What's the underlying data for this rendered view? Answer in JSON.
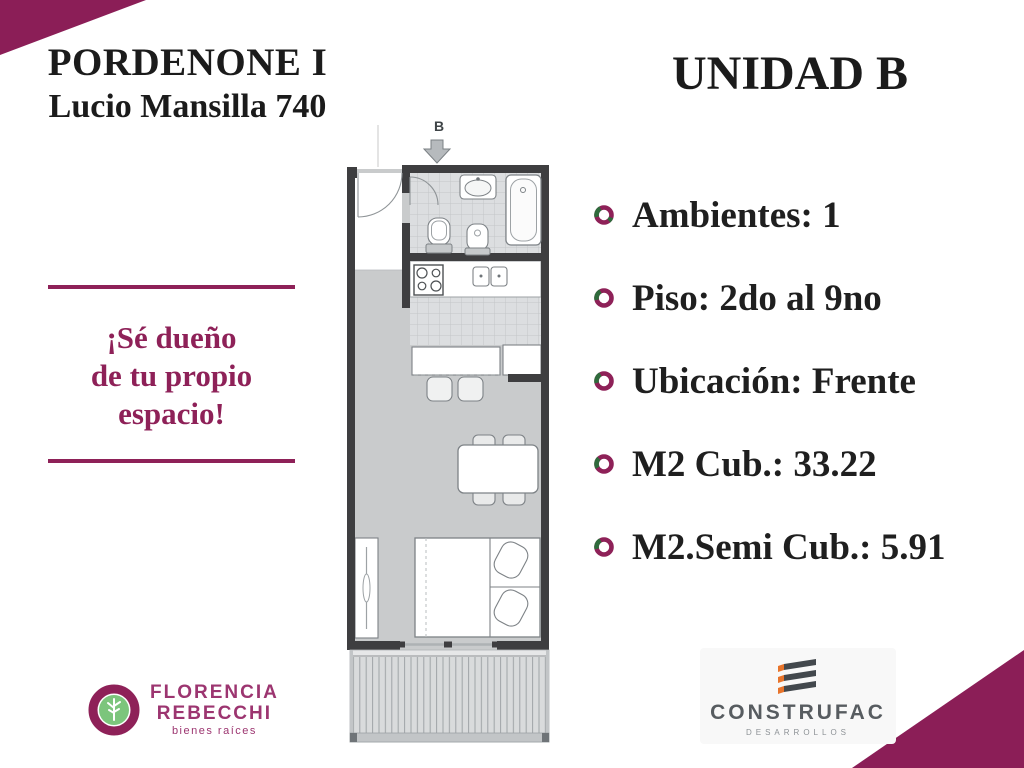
{
  "header": {
    "project_title": "PORDENONE I",
    "address": "Lucio Mansilla 740",
    "unit_title": "UNIDAD B"
  },
  "features": {
    "items": [
      "Ambientes: 1",
      "Piso: 2do al 9no",
      "Ubicación: Frente",
      "M2 Cub.: 33.22",
      "M2.Semi Cub.: 5.91"
    ]
  },
  "slogan": {
    "line1": "¡Sé dueño",
    "line2": "de tu propio",
    "line3": "espacio!"
  },
  "floorplan": {
    "entrance_label": "B"
  },
  "logos": {
    "agency": {
      "name_line1": "FLORENCIA",
      "name_line2": "REBECCHI",
      "tagline": "bienes raíces"
    },
    "developer": {
      "name": "CONSTRUFAC",
      "tagline": "DESARROLLOS"
    }
  },
  "colors": {
    "accent_magenta": "#8e2158",
    "corner_triangle": "#8b1e57",
    "bullet_green": "#2f6b3c",
    "text_dark": "#1f1f1f",
    "logo_green": "#7cc57c",
    "logo_orange": "#e8742b",
    "developer_gray": "#575c60",
    "plan_wall": "#3e3e40",
    "plan_floor": "#c9cbcc",
    "plan_tile": "#dcdee0"
  }
}
